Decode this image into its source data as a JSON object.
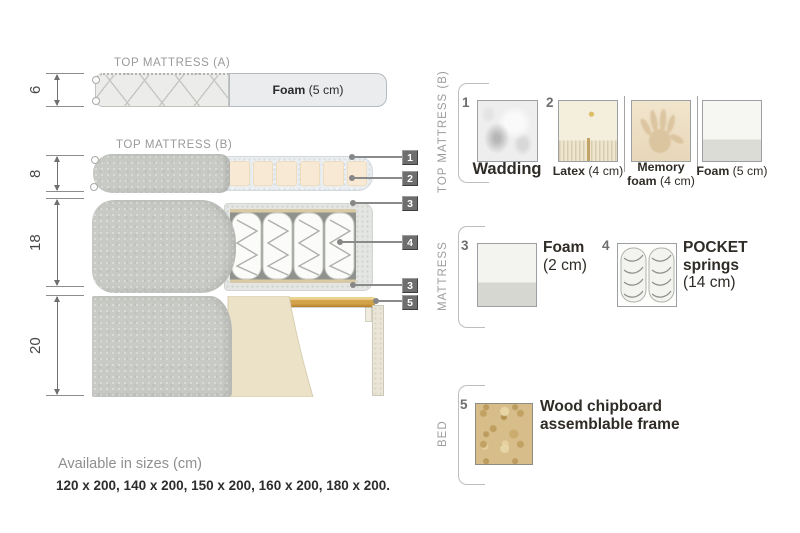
{
  "diagram": {
    "title_a": "TOP MATTRESS (A)",
    "title_b": "TOP MATTRESS (B)",
    "dim_a": "6",
    "dim_b": "8",
    "dim_mattress": "18",
    "dim_bed": "20",
    "foam_a": {
      "bold": "Foam",
      "rest": " (5 cm)"
    },
    "callouts": {
      "n1": "1",
      "n2": "2",
      "n3": "3",
      "n4": "4",
      "n3b": "3",
      "n5": "5"
    }
  },
  "legend": {
    "sections": {
      "top_b": "TOP MATTRESS (B)",
      "mattress": "MATTRESS",
      "bed": "BED"
    },
    "wadding": {
      "num": "1",
      "label": "Wadding"
    },
    "latex": {
      "num": "2",
      "bold": "Latex",
      "rest": " (4 cm)"
    },
    "memory": {
      "line1": "Memory",
      "line2_bold": "foam",
      "line2_rest": " (4 cm)"
    },
    "foam5": {
      "bold": "Foam",
      "rest": " (5 cm)"
    },
    "foam2": {
      "num": "3",
      "line1": "Foam",
      "line2": "(2 cm)"
    },
    "pocket": {
      "num": "4",
      "line1": "POCKET",
      "line2": "springs",
      "line3": "(14 cm)"
    },
    "wood": {
      "num": "5",
      "line1": "Wood chipboard",
      "line2": "assemblable frame"
    }
  },
  "footer": {
    "available": "Available in sizes (cm)",
    "sizes": "120 x 200, 140 x 200, 150 x 200, 160 x 200, 180 x 200."
  },
  "colors": {
    "wood": "#c9973e",
    "fabric": "#c8cac5",
    "cream": "#f6e8d2",
    "callout": "#6e6e6e"
  }
}
